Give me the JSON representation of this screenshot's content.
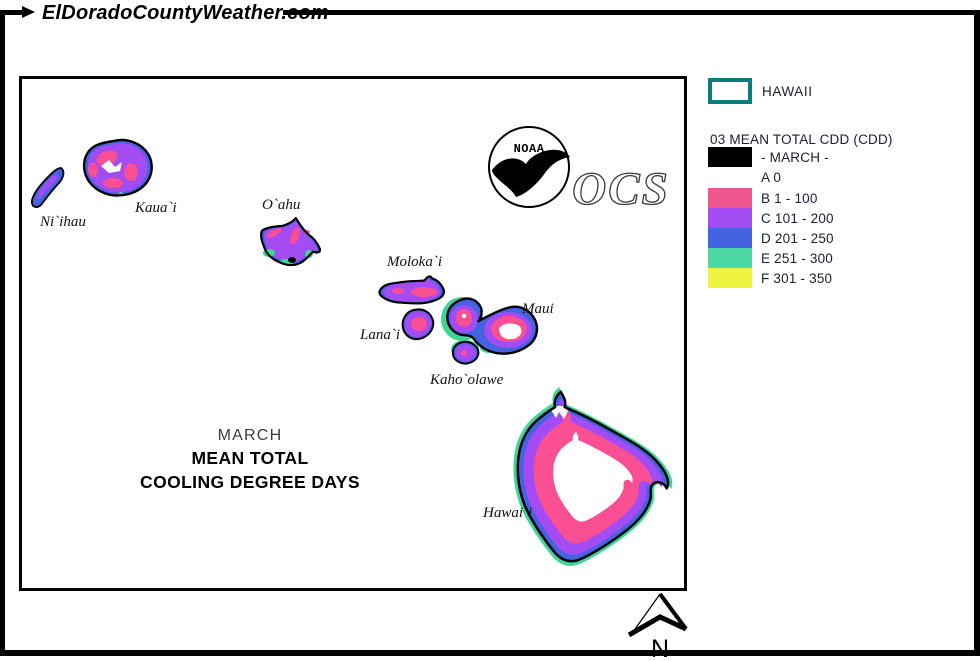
{
  "site": {
    "title": "ElDoradoCountyWeather.com"
  },
  "map_panel": {
    "title_line1": "MARCH",
    "title_line2": "MEAN TOTAL",
    "title_line3": "COOLING DEGREE DAYS",
    "islands": {
      "niihau": "Ni`ihau",
      "kauai": "Kaua`i",
      "oahu": "O`ahu",
      "molokai": "Moloka`i",
      "lanai": "Lana`i",
      "maui": "Maui",
      "kahoolawe": "Kaho`olawe",
      "hawaii": "Hawai`i"
    },
    "noaa_logo_text": "NOAA",
    "ocs_logo_text": "OCS",
    "north_arrow_label": "N"
  },
  "legend": {
    "region_label": "HAWAII",
    "region_outline_color": "#0a7e7e",
    "title": "03 MEAN TOTAL CDD (CDD)",
    "month_label": "- MARCH -",
    "month_swatch_color": "#000000",
    "entries": [
      {
        "class": "A",
        "label": "A 0",
        "color": "#ffffff"
      },
      {
        "class": "B",
        "label": "B 1 - 100",
        "color": "#ef568d"
      },
      {
        "class": "C",
        "label": "C 101 - 200",
        "color": "#a44cf4"
      },
      {
        "class": "D",
        "label": "D 201 - 250",
        "color": "#4463e0"
      },
      {
        "class": "E",
        "label": "E 251 - 300",
        "color": "#4ed8a4"
      },
      {
        "class": "F",
        "label": "F 301 - 350",
        "color": "#edf33e"
      }
    ]
  },
  "colors": {
    "pink": "#fb4f93",
    "purple": "#a44cf4",
    "blue": "#4463e0",
    "green": "#3fd695",
    "yellow": "#f2f53c",
    "coast": "#000000",
    "teal": "#0a7e7e",
    "text": "#1c1c34"
  }
}
